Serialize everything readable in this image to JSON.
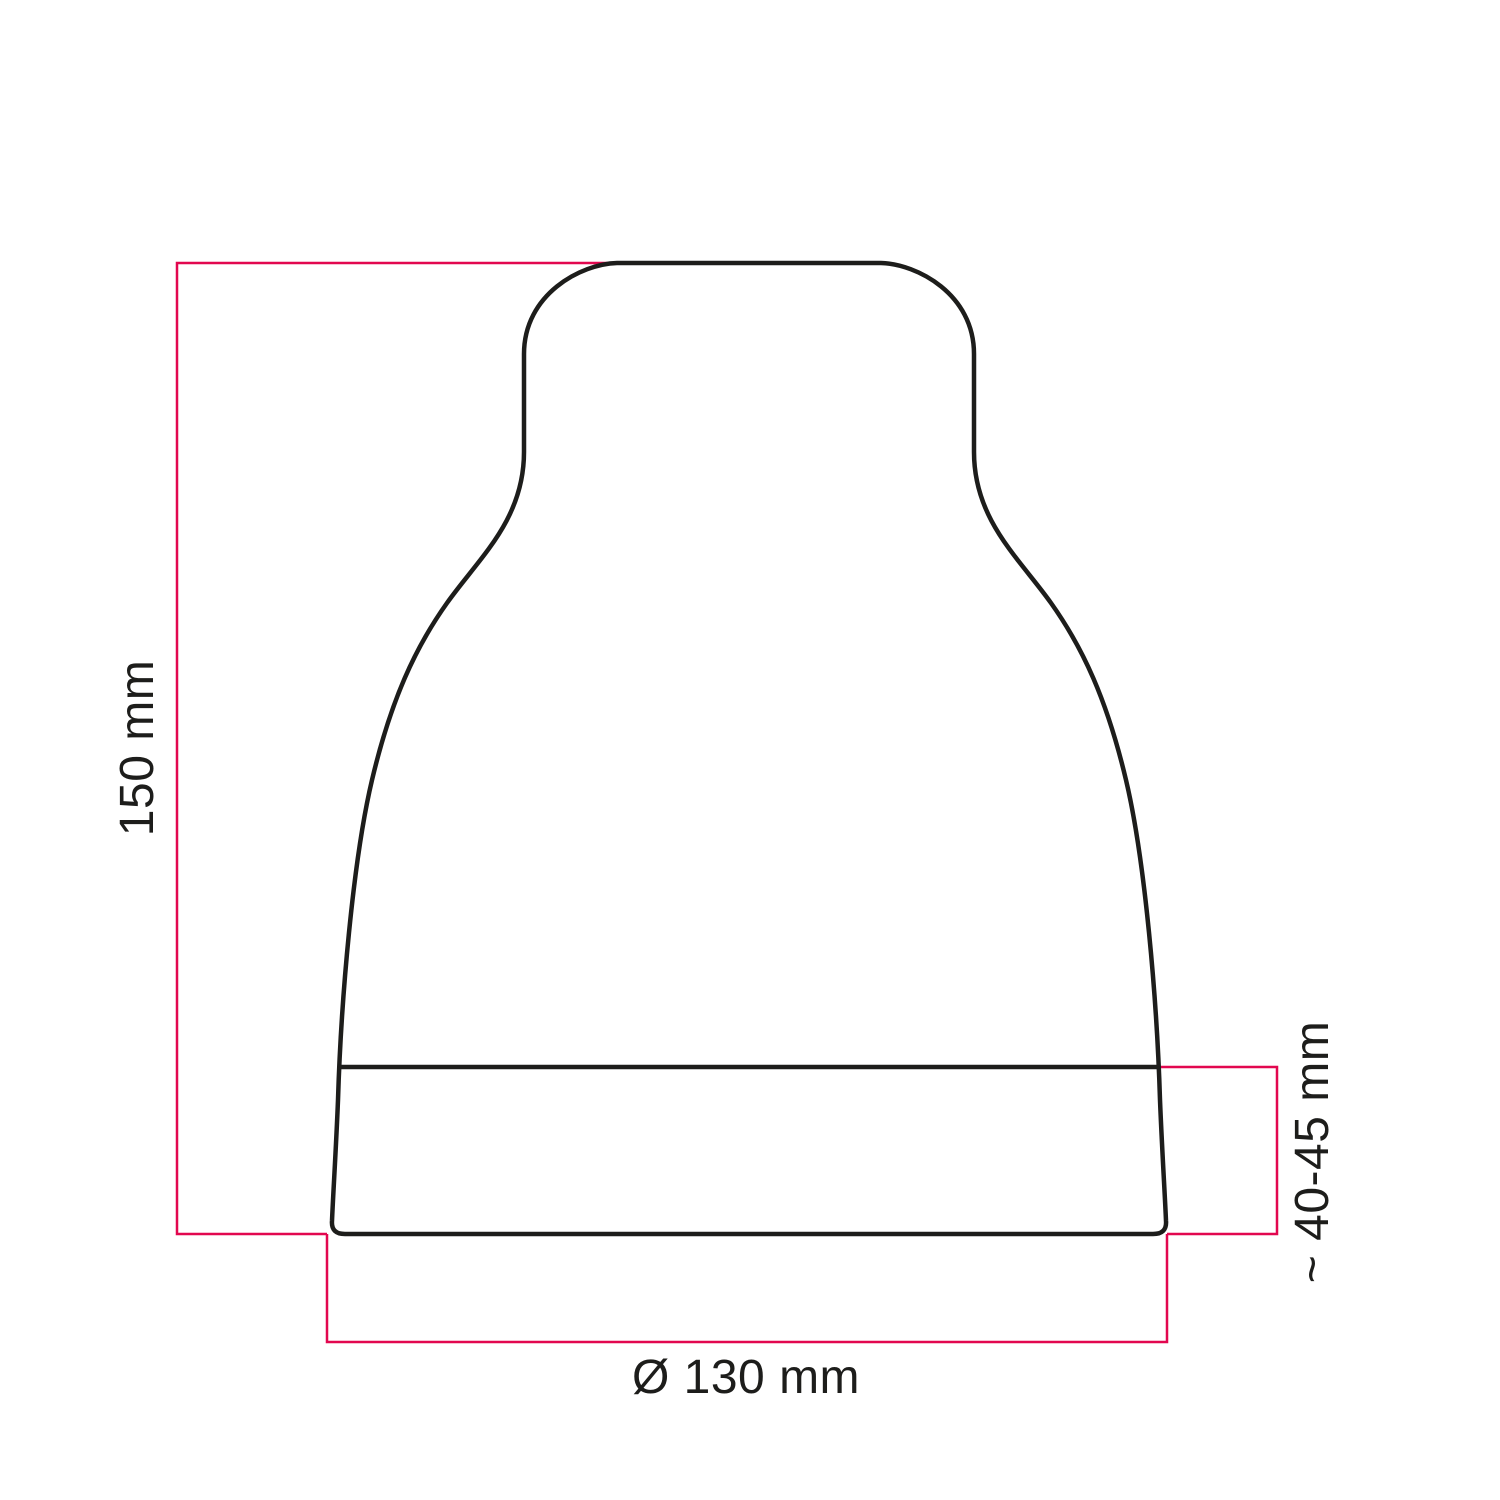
{
  "drawing": {
    "labels": {
      "height": "150 mm",
      "ferrule_height": "~ 40-45 mm",
      "diameter": "Ø 130 mm"
    },
    "colors": {
      "outline": "#1d1d1b",
      "dimension_line": "#e2074f",
      "label_text": "#1d1d1b",
      "background": "#ffffff"
    }
  }
}
